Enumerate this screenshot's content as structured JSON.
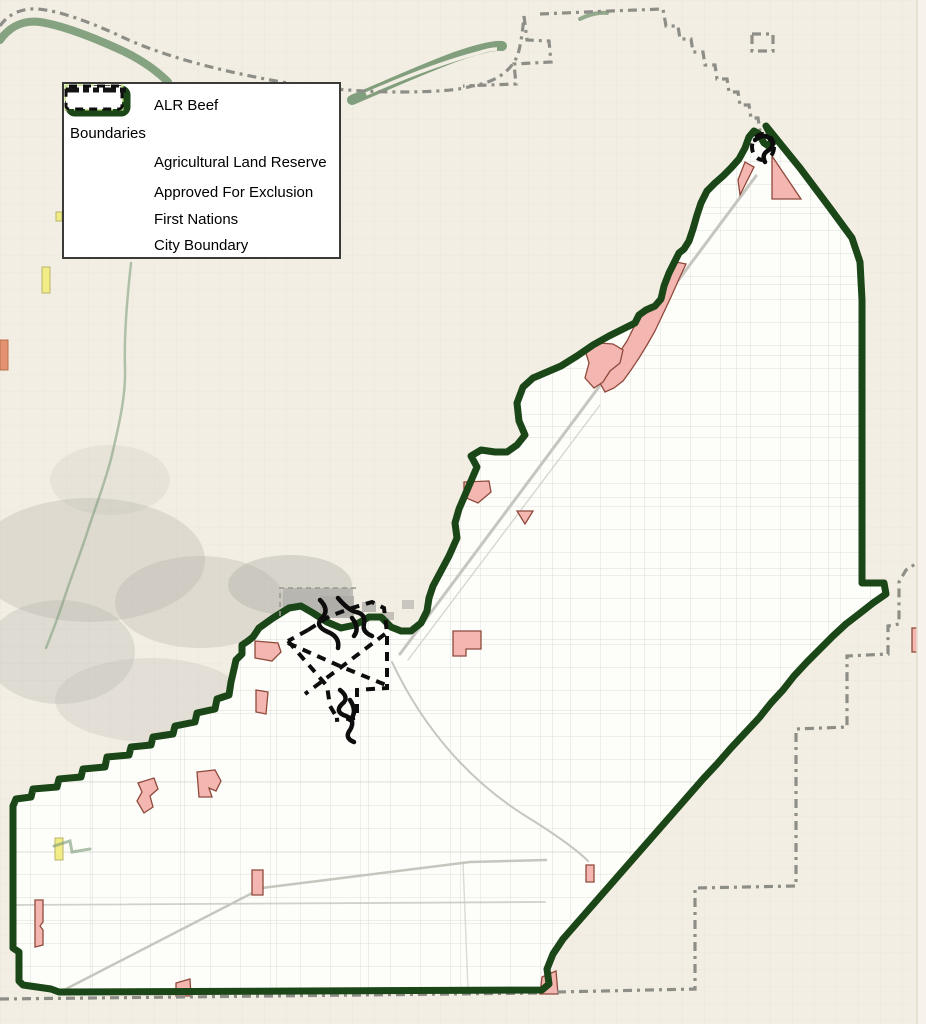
{
  "legend": {
    "items": [
      {
        "label": "ALR Beef",
        "swatch": "beef-fill-swatch"
      },
      {
        "label": "Boundaries",
        "swatch": "none"
      },
      {
        "label": "Agricultural Land Reserve",
        "swatch": "thick-green-outline-swatch"
      },
      {
        "label": "Approved For Exclusion",
        "swatch": "light-green-dashed-swatch"
      },
      {
        "label": "First Nations",
        "swatch": "black-dashed-outline-swatch"
      },
      {
        "label": "City Boundary",
        "swatch": "black-dash-dot-line"
      }
    ]
  },
  "colors": {
    "alr_beef_fill": "#f4b6b0",
    "alr_beef_border": "#8f4a3c",
    "alr_boundary_green": "#1b4617",
    "approved_exclusion_fill": "#eff6d9",
    "approved_exclusion_border": "#c6e08a",
    "first_nations_black": "#0d0d0d",
    "city_boundary_legend": "#141414",
    "city_boundary_map_gray": "#8e8e88",
    "neighboring_alr_green": "#7a9a76",
    "map_background": "#f2eee3",
    "alr_interior": "#fdfdfa",
    "parcel_line": "#bcbcb6",
    "urban_gray": "#aeaca7",
    "yellow_parcel": "#f1ec85",
    "orange_parcel": "#e2926e"
  }
}
